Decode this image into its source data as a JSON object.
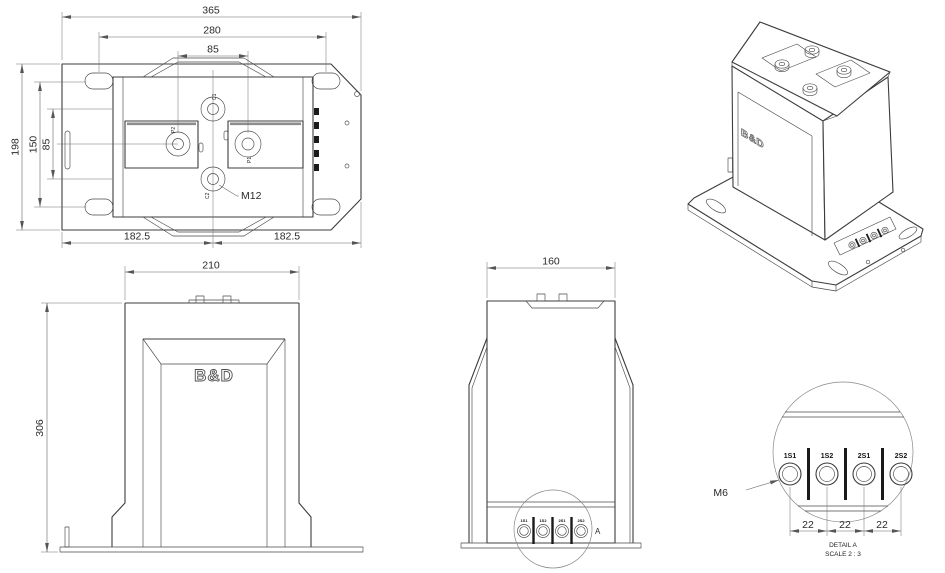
{
  "colors": {
    "background": "#ffffff",
    "line": "#3c3c3c",
    "dimension": "#666666",
    "text": "#2a2a2a"
  },
  "top_view": {
    "dim_width_overall": "365",
    "dim_mount_width": "280",
    "dim_primary_pitch": "85",
    "dim_depth_overall": "198",
    "dim_mount_depth": "150",
    "dim_stud_pitch": "85",
    "dim_left_half": "182.5",
    "dim_right_half": "182.5",
    "thread_label": "M12",
    "terminal_labels": {
      "c1": "C1",
      "c2": "C2",
      "p1": "P1",
      "p2": "P2"
    }
  },
  "front_view": {
    "dim_width": "210",
    "dim_height": "306",
    "logo": "B&D"
  },
  "side_view": {
    "dim_width": "160",
    "detail_marker": "A",
    "terminals": [
      "1S1",
      "1S2",
      "2S1",
      "2S2"
    ]
  },
  "iso_view": {
    "logo": "B&D"
  },
  "detail_a": {
    "thread_label": "M6",
    "terminals": [
      "1S1",
      "1S2",
      "2S1",
      "2S2"
    ],
    "pitch_dims": [
      "22",
      "22",
      "22"
    ],
    "caption_title": "DETAIL A",
    "caption_scale": "SCALE 2 : 3"
  }
}
